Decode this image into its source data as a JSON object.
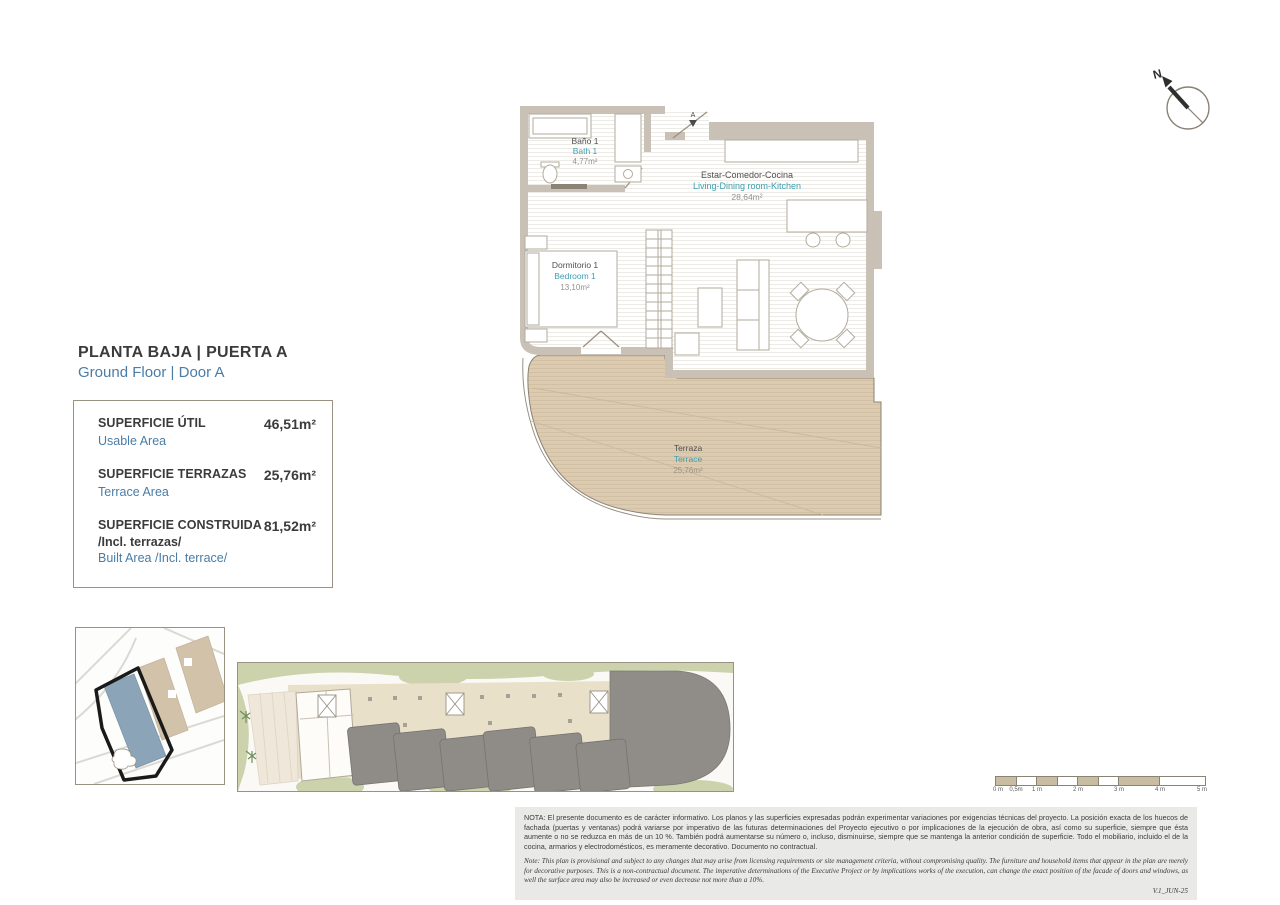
{
  "header": {
    "title_es": "PLANTA BAJA | PUERTA A",
    "title_en": "Ground Floor | Door A"
  },
  "area_table": {
    "rows": [
      {
        "label_es": "SUPERFICIE ÚTIL",
        "label_es_extra": "",
        "label_en": "Usable Area",
        "value": "46,51m²"
      },
      {
        "label_es": "SUPERFICIE TERRAZAS",
        "label_es_extra": "",
        "label_en": "Terrace Area",
        "value": "25,76m²"
      },
      {
        "label_es": "SUPERFICIE CONSTRUIDA",
        "label_es_extra": "/Incl. terrazas/",
        "label_en": "Built Area /Incl. terrace/",
        "value": "81,52m²"
      }
    ]
  },
  "floor_plan": {
    "door_label": "A",
    "rooms": [
      {
        "name_es": "Baño 1",
        "name_en": "Bath 1",
        "area": "4,77m²"
      },
      {
        "name_es": "Estar-Comedor-Cocina",
        "name_en": "Living-Dining room-Kitchen",
        "area": "28,64m²"
      },
      {
        "name_es": "Dormitorio 1",
        "name_en": "Bedroom 1",
        "area": "13,10m²"
      },
      {
        "name_es": "Terraza",
        "name_en": "Terrace",
        "area": "25,76m²"
      }
    ]
  },
  "compass": {
    "label": "N"
  },
  "scale_bar": {
    "labels": [
      "0 m",
      "0,5m",
      "1 m",
      "2 m",
      "3 m",
      "4 m",
      "5 m"
    ]
  },
  "notes": {
    "nota_es": "NOTA: El presente documento es de carácter informativo. Los planos y las superficies expresadas podrán experimentar variaciones por exigencias técnicas del proyecto. La posición exacta de los huecos de fachada (puertas y ventanas) podrá variarse por imperativo de las futuras determinaciones del Proyecto ejecutivo o por implicaciones de la ejecución de obra, así como su superficie, siempre que ésta aumente o no se reduzca en más de un 10 %. También podrá aumentarse su número o, incluso, disminuirse, siempre que se mantenga la anterior condición de superficie. Todo el mobiliario, incluido el de la cocina, armarios y electrodomésticos, es meramente decorativo. Documento no contractual.",
    "note_en": "Note: This plan is provisional and subject to any changes that may arise from licensing requirements or site management criteria, without compromising quality. The furniture and household items that appear in the plan are merely for decorative purposes. This is a non-contractual document. The imperative determinations of the Executive Project or by implications works of the execution, can change the exact position of the facade of doors and windows, as well the surface area may also be increased or even decrease not more than a 10%.",
    "version": "V.1_JUN-25"
  },
  "colors": {
    "accent_blue": "#4a7ca6",
    "accent_teal": "#3aa0b2",
    "terrace_tan": "#dccbb1",
    "wall_gray": "#c9c1b5",
    "site_highlight_blue": "#8ba4b8",
    "building_tan": "#d2c2aa"
  }
}
